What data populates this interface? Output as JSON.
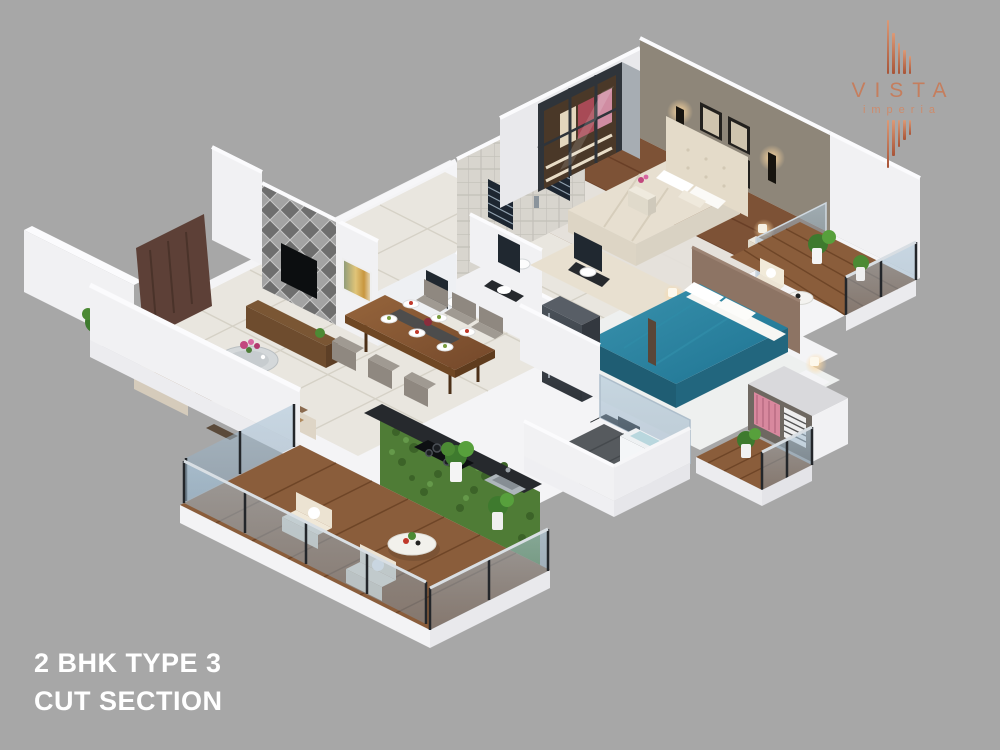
{
  "brand": {
    "name": "VISTA",
    "subtitle": "imperia"
  },
  "caption": {
    "line1": "2 BHK TYPE 3",
    "line2": "CUT SECTION"
  },
  "colors": {
    "background": "#a7a7a7",
    "slab_white": "#f4f4f6",
    "wall_white": "#f1f1f3",
    "wall_shade": "#e7e7ea",
    "marble_floor": "#e9e6df",
    "marble_line": "#d5d1c6",
    "wood_floor": "#7d5236",
    "deck_wood": "#8a5d3b",
    "deck_line": "#6e4527",
    "accent_gray_wall": "#8e8679",
    "diamond_light": "#9f9f9f",
    "diamond_dark": "#6e6e6e",
    "bath_tile": "#d8d5ce",
    "teal_bed": "#2a7e9c",
    "headboard_brown": "#8d7464",
    "cream_bed": "#e7dfd0",
    "sofa_cream": "#ded5c6",
    "cushion_brown": "#a97f52",
    "rug_brown": "#8a6a4e",
    "rug_cream": "#e8e0d0",
    "granite_dark": "#26292d",
    "green_wall": "#4f7c36",
    "plant_green": "#3e7a2e",
    "glass_frame": "#23262a",
    "door_brown": "#5d4037",
    "tv_black": "#0c0e10",
    "mirror_dark": "#202830",
    "dark_tile_floor": "#565a5e",
    "warm_light": "#ffd9a0",
    "copper": "#c57e5e",
    "title_white": "#ffffff"
  },
  "scene": {
    "rooms": [
      "living-room",
      "dining-area",
      "kitchen",
      "master-bedroom",
      "bedroom-2",
      "bathroom-1",
      "bathroom-2",
      "main-balcony",
      "bedroom-balcony",
      "utility-balcony",
      "small-deck",
      "entrance-foyer"
    ]
  }
}
